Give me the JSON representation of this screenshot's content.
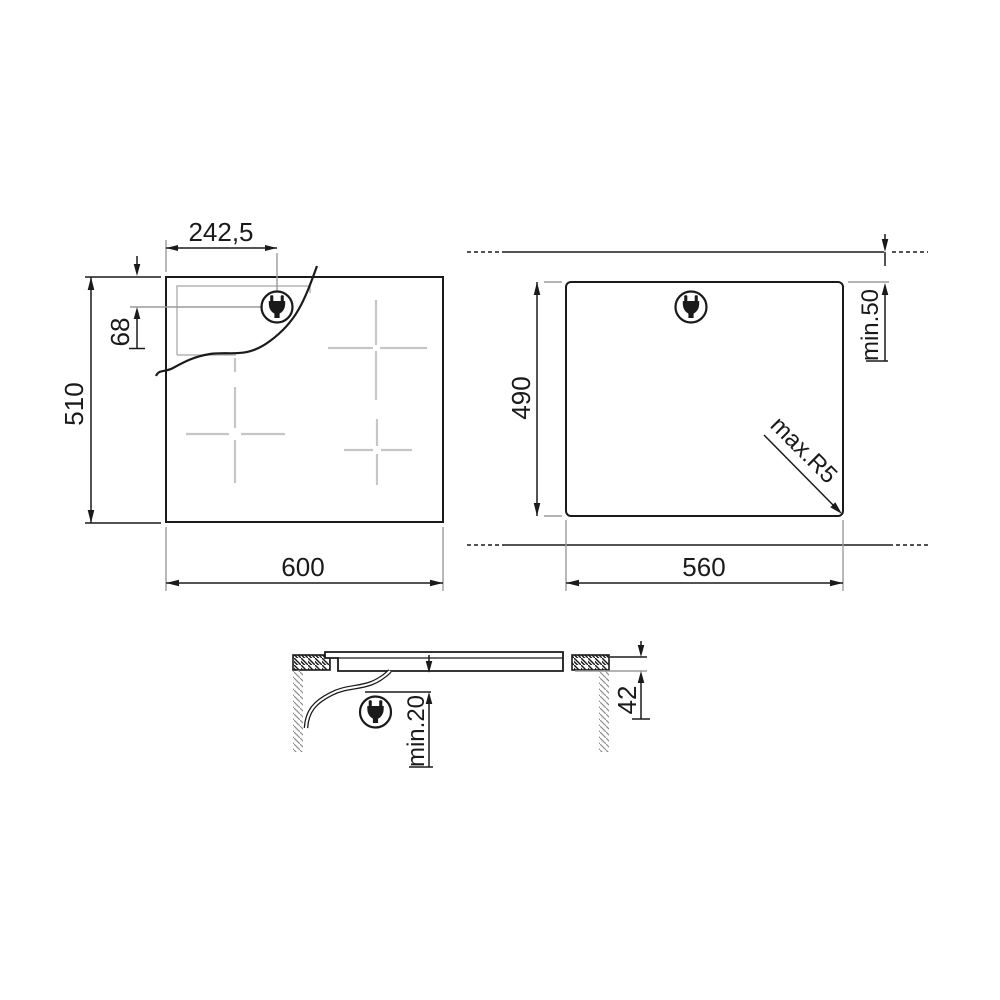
{
  "page": {
    "background": "#ffffff"
  },
  "colors": {
    "line": "#1a1a1a",
    "extension_line": "#9b9b9b",
    "hidden_edge": "#b5b5b5",
    "zone_cross": "#c6c6c6"
  },
  "top_view": {
    "width": "600",
    "height": "510",
    "plug_offset_x": "242,5",
    "plug_offset_y": "68",
    "plug_icon": "power-plug-icon"
  },
  "cutout_view": {
    "width": "560",
    "depth": "490",
    "min_top_clearance": "min.50",
    "max_corner_radius": "max.R5",
    "plug_icon": "power-plug-icon"
  },
  "side_view": {
    "hob_height": "42",
    "min_bottom_clearance": "min.20",
    "plug_icon": "power-plug-icon"
  }
}
